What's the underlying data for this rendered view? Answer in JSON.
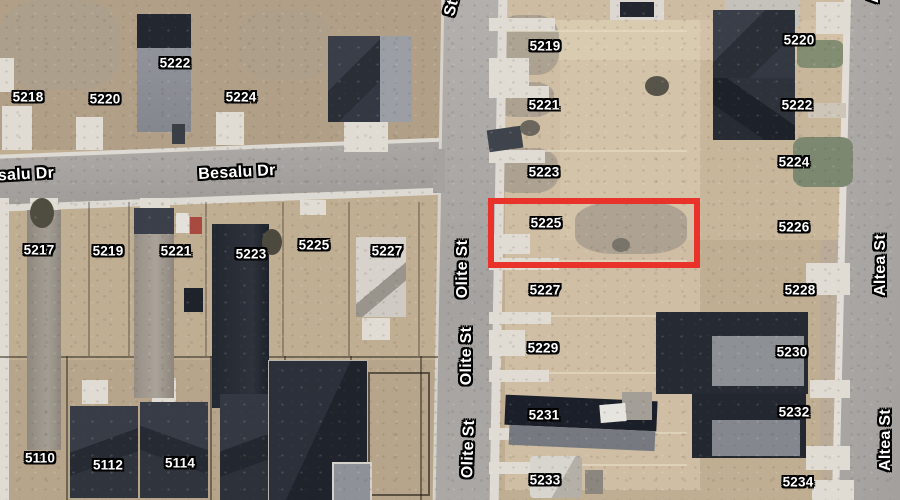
{
  "map": {
    "type": "satellite-aerial-parcel-map",
    "highlighted_parcel": {
      "number": "5225",
      "x": 488,
      "y": 198,
      "width": 200,
      "height": 58,
      "border_color": "#e8322a",
      "border_width": 6
    },
    "street_labels": [
      {
        "text": "salu Dr",
        "x": 26,
        "y": 175,
        "rotate": -3
      },
      {
        "text": "Besalu Dr",
        "x": 237,
        "y": 173,
        "rotate": -3
      },
      {
        "text": "St",
        "x": 452,
        "y": 8,
        "rotate": -75
      },
      {
        "text": "Olite St",
        "x": 463,
        "y": 269,
        "rotate": -90
      },
      {
        "text": "Olite St",
        "x": 467,
        "y": 356,
        "rotate": -90
      },
      {
        "text": "Olite St",
        "x": 469,
        "y": 449,
        "rotate": -88
      },
      {
        "text": "Altea St",
        "x": 874,
        "y": -28,
        "rotate": -90
      },
      {
        "text": "Altea St",
        "x": 881,
        "y": 265,
        "rotate": -90
      },
      {
        "text": "Altea St",
        "x": 886,
        "y": 440,
        "rotate": -90
      }
    ],
    "address_labels": {
      "west_of_olite": [
        {
          "text": "5218",
          "x": 28,
          "y": 97
        },
        {
          "text": "5220",
          "x": 105,
          "y": 99
        },
        {
          "text": "5222",
          "x": 175,
          "y": 63
        },
        {
          "text": "5224",
          "x": 241,
          "y": 97
        },
        {
          "text": "5217",
          "x": 39,
          "y": 250
        },
        {
          "text": "5219",
          "x": 108,
          "y": 251
        },
        {
          "text": "5221",
          "x": 176,
          "y": 251
        },
        {
          "text": "5223",
          "x": 251,
          "y": 254
        },
        {
          "text": "5225",
          "x": 314,
          "y": 245
        },
        {
          "text": "5227",
          "x": 387,
          "y": 251
        },
        {
          "text": "5110",
          "x": 40,
          "y": 458
        },
        {
          "text": "5112",
          "x": 108,
          "y": 465
        },
        {
          "text": "5114",
          "x": 180,
          "y": 463
        }
      ],
      "east_of_olite": [
        {
          "text": "5219",
          "x": 545,
          "y": 46
        },
        {
          "text": "5221",
          "x": 544,
          "y": 105
        },
        {
          "text": "5223",
          "x": 544,
          "y": 172
        },
        {
          "text": "5225",
          "x": 546,
          "y": 223
        },
        {
          "text": "5227",
          "x": 545,
          "y": 290
        },
        {
          "text": "5229",
          "x": 543,
          "y": 348
        },
        {
          "text": "5231",
          "x": 544,
          "y": 415
        },
        {
          "text": "5233",
          "x": 545,
          "y": 480
        }
      ],
      "west_of_altea": [
        {
          "text": "5220",
          "x": 799,
          "y": 40
        },
        {
          "text": "5222",
          "x": 797,
          "y": 105
        },
        {
          "text": "5224",
          "x": 794,
          "y": 162
        },
        {
          "text": "5226",
          "x": 794,
          "y": 227
        },
        {
          "text": "5228",
          "x": 800,
          "y": 290
        },
        {
          "text": "5230",
          "x": 792,
          "y": 352
        },
        {
          "text": "5232",
          "x": 794,
          "y": 412
        },
        {
          "text": "5234",
          "x": 798,
          "y": 482
        }
      ]
    },
    "colors": {
      "highlight_red": "#e8322a",
      "label_text": "#ffffff",
      "label_outline": "#000000",
      "dirt": "#c0ae93",
      "road": "#a5a2a0",
      "sidewalk": "#dfdbd4",
      "house_dark": "#2b2f38"
    }
  }
}
